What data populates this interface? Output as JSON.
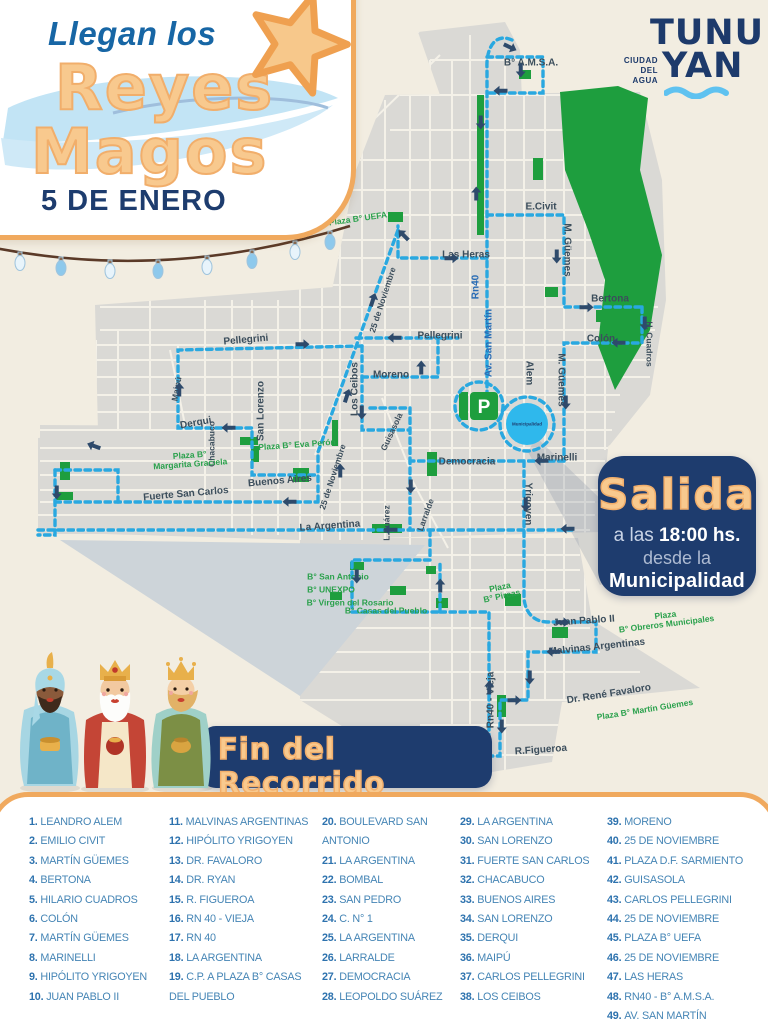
{
  "header": {
    "title_top": "Llegan los",
    "title_main_1": "Reyes",
    "title_main_2": "Magos",
    "date": "5 DE ENERO"
  },
  "logo": {
    "line1": "TUNU",
    "line2": "YAN",
    "tagline1": "CIUDAD",
    "tagline2": "DEL",
    "tagline3": "AGUA"
  },
  "salida": {
    "title": "Salida",
    "line1_pre": "a las ",
    "line1_bold": "18:00 hs.",
    "line2": "desde la",
    "line3": "Municipalidad"
  },
  "fin": {
    "title": "Fin del Recorrido",
    "sub_pre": "a las ",
    "sub_bold1": "22:00 hs.",
    "sub_mid": " aprox. en la ",
    "sub_bold2": "Plaza Departamental"
  },
  "map": {
    "roundabout_label": "Municipalidad",
    "parking_label": "P",
    "labels": [
      {
        "t": "B° A.M.S.A.",
        "x": 531,
        "y": 64,
        "r": 0,
        "c": "st"
      },
      {
        "t": "E.Civit",
        "x": 541,
        "y": 208,
        "r": 0,
        "c": "st"
      },
      {
        "t": "M. Güemes",
        "x": 566,
        "y": 250,
        "r": 90,
        "c": "st"
      },
      {
        "t": "Las Heras",
        "x": 466,
        "y": 256,
        "r": 0,
        "c": "st"
      },
      {
        "t": "Bertona",
        "x": 610,
        "y": 300,
        "r": 0,
        "c": "st"
      },
      {
        "t": "Colón",
        "x": 601,
        "y": 340,
        "r": 0,
        "c": "st"
      },
      {
        "t": "H. Cuadros",
        "x": 649,
        "y": 344,
        "r": 90,
        "c": "st sm"
      },
      {
        "t": "M. Güemes",
        "x": 560,
        "y": 380,
        "r": 90,
        "c": "st"
      },
      {
        "t": "Plaza B° UEFA",
        "x": 358,
        "y": 219,
        "r": -8,
        "c": "pz"
      },
      {
        "t": "Pellegrini",
        "x": 246,
        "y": 341,
        "r": -5,
        "c": "st"
      },
      {
        "t": "Pellegrini",
        "x": 440,
        "y": 337,
        "r": 0,
        "c": "st"
      },
      {
        "t": "Moreno",
        "x": 391,
        "y": 376,
        "r": 0,
        "c": "st"
      },
      {
        "t": "25 de Noviembre",
        "x": 383,
        "y": 300,
        "r": -72,
        "c": "st sm"
      },
      {
        "t": "Rn40",
        "x": 477,
        "y": 287,
        "r": -90,
        "c": "hw"
      },
      {
        "t": "Av. San Martín",
        "x": 490,
        "y": 343,
        "r": -90,
        "c": "hw"
      },
      {
        "t": "Alem",
        "x": 528,
        "y": 373,
        "r": 90,
        "c": "st"
      },
      {
        "t": "Maipú",
        "x": 177,
        "y": 389,
        "r": -80,
        "c": "st sm"
      },
      {
        "t": "Derqui",
        "x": 196,
        "y": 424,
        "r": -10,
        "c": "st"
      },
      {
        "t": "San Lorenzo",
        "x": 262,
        "y": 411,
        "r": -90,
        "c": "st"
      },
      {
        "t": "Los Ceibos",
        "x": 356,
        "y": 389,
        "r": -90,
        "c": "st"
      },
      {
        "t": "Chacabuco",
        "x": 212,
        "y": 444,
        "r": -90,
        "c": "st sm"
      },
      {
        "t": "Plaza B°\nMargarita Graciela",
        "x": 190,
        "y": 460,
        "r": -4,
        "c": "pz"
      },
      {
        "t": "Plaza B° Eva Perón",
        "x": 297,
        "y": 445,
        "r": -4,
        "c": "pz"
      },
      {
        "t": "Buenos Aires",
        "x": 280,
        "y": 482,
        "r": -5,
        "c": "st"
      },
      {
        "t": "Fuerte San Carlos",
        "x": 186,
        "y": 495,
        "r": -5,
        "c": "st"
      },
      {
        "t": "25 de Noviembre",
        "x": 333,
        "y": 477,
        "r": -72,
        "c": "st sm"
      },
      {
        "t": "Guisasola",
        "x": 392,
        "y": 432,
        "r": -65,
        "c": "st sm"
      },
      {
        "t": "La Argentina",
        "x": 330,
        "y": 527,
        "r": -4,
        "c": "st"
      },
      {
        "t": "L.Suárez",
        "x": 387,
        "y": 523,
        "r": -90,
        "c": "st sm"
      },
      {
        "t": "Larralde",
        "x": 426,
        "y": 515,
        "r": -70,
        "c": "st sm"
      },
      {
        "t": "Democracia",
        "x": 467,
        "y": 463,
        "r": 0,
        "c": "st"
      },
      {
        "t": "Marinelli",
        "x": 557,
        "y": 459,
        "r": 0,
        "c": "st"
      },
      {
        "t": "Yrigoyen",
        "x": 527,
        "y": 504,
        "r": 90,
        "c": "st"
      },
      {
        "t": "B° San Antonio",
        "x": 338,
        "y": 577,
        "r": 0,
        "c": "pz"
      },
      {
        "t": "B° UNEXPO",
        "x": 331,
        "y": 590,
        "r": 0,
        "c": "pz"
      },
      {
        "t": "B° Virgen del Rosario",
        "x": 350,
        "y": 603,
        "r": 0,
        "c": "pz"
      },
      {
        "t": "B° Casas del Pueblo",
        "x": 386,
        "y": 611,
        "r": 0,
        "c": "pz"
      },
      {
        "t": "Plaza\nB° Pircas",
        "x": 501,
        "y": 592,
        "r": -12,
        "c": "pz"
      },
      {
        "t": "Juan Pablo II",
        "x": 584,
        "y": 622,
        "r": -4,
        "c": "st"
      },
      {
        "t": "Plaza\nB° Obreros Municipales",
        "x": 666,
        "y": 620,
        "r": -7,
        "c": "pz"
      },
      {
        "t": "Malvinas Argentinas",
        "x": 597,
        "y": 648,
        "r": -6,
        "c": "st"
      },
      {
        "t": "Dr. René Favaloro",
        "x": 609,
        "y": 695,
        "r": -9,
        "c": "st"
      },
      {
        "t": "Plaza B° Martín Güemes",
        "x": 645,
        "y": 710,
        "r": -9,
        "c": "pz"
      },
      {
        "t": "Rn40 - Vieja",
        "x": 492,
        "y": 700,
        "r": -90,
        "c": "st"
      },
      {
        "t": "R.Figueroa",
        "x": 541,
        "y": 751,
        "r": -4,
        "c": "st"
      }
    ],
    "arrows": [
      [
        508,
        46,
        25
      ],
      [
        521,
        68,
        90
      ],
      [
        503,
        91,
        180
      ],
      [
        481,
        120,
        90
      ],
      [
        476,
        196,
        -90
      ],
      [
        449,
        258,
        0
      ],
      [
        405,
        237,
        -135
      ],
      [
        557,
        254,
        90
      ],
      [
        584,
        307,
        0
      ],
      [
        645,
        321,
        90
      ],
      [
        621,
        343,
        180
      ],
      [
        566,
        400,
        90
      ],
      [
        544,
        461,
        180
      ],
      [
        526,
        502,
        90
      ],
      [
        560,
        622,
        0
      ],
      [
        556,
        652,
        180
      ],
      [
        530,
        675,
        90
      ],
      [
        512,
        700,
        0
      ],
      [
        502,
        724,
        90
      ],
      [
        461,
        756,
        180
      ],
      [
        489,
        690,
        -90
      ],
      [
        300,
        344,
        0
      ],
      [
        397,
        338,
        180
      ],
      [
        179,
        392,
        -90
      ],
      [
        231,
        428,
        180
      ],
      [
        372,
        302,
        -72
      ],
      [
        346,
        398,
        -72
      ],
      [
        421,
        370,
        -90
      ],
      [
        362,
        410,
        90
      ],
      [
        411,
        484,
        90
      ],
      [
        393,
        530,
        180
      ],
      [
        570,
        529,
        180
      ],
      [
        292,
        502,
        180
      ],
      [
        340,
        473,
        -90
      ],
      [
        357,
        574,
        90
      ],
      [
        440,
        588,
        -90
      ],
      [
        96,
        447,
        -160
      ],
      [
        57,
        490,
        90
      ]
    ]
  },
  "streets": {
    "columns": [
      [
        {
          "n": "1.",
          "name": "LEANDRO ALEM"
        },
        {
          "n": "2.",
          "name": "EMILIO CIVIT"
        },
        {
          "n": "3.",
          "name": "MARTÍN GÜEMES"
        },
        {
          "n": "4.",
          "name": "BERTONA"
        },
        {
          "n": "5.",
          "name": "HILARIO CUADROS"
        },
        {
          "n": "6.",
          "name": "COLÓN"
        },
        {
          "n": "7.",
          "name": "MARTÍN GÜEMES"
        },
        {
          "n": "8.",
          "name": "MARINELLI"
        },
        {
          "n": "9.",
          "name": "HIPÓLITO YRIGOYEN"
        },
        {
          "n": "10.",
          "name": "JUAN PABLO II"
        }
      ],
      [
        {
          "n": "11.",
          "name": "MALVINAS ARGENTINAS"
        },
        {
          "n": "12.",
          "name": "HIPÓLITO YRIGOYEN"
        },
        {
          "n": "13.",
          "name": "DR. FAVALORO"
        },
        {
          "n": "14.",
          "name": "DR. RYAN"
        },
        {
          "n": "15.",
          "name": "R. FIGUEROA"
        },
        {
          "n": "16.",
          "name": "RN 40 - VIEJA"
        },
        {
          "n": "17.",
          "name": "RN 40"
        },
        {
          "n": "18.",
          "name": "LA ARGENTINA"
        },
        {
          "n": "19.",
          "name": "C.P. A PLAZA B° CASAS DEL PUEBLO"
        }
      ],
      [
        {
          "n": "20.",
          "name": "BOULEVARD SAN ANTONIO"
        },
        {
          "n": "21.",
          "name": "LA ARGENTINA"
        },
        {
          "n": "22.",
          "name": "BOMBAL"
        },
        {
          "n": "23.",
          "name": "SAN PEDRO"
        },
        {
          "n": "24.",
          "name": "C. N° 1"
        },
        {
          "n": "25.",
          "name": "LA ARGENTINA"
        },
        {
          "n": "26.",
          "name": "LARRALDE"
        },
        {
          "n": "27.",
          "name": "DEMOCRACIA"
        },
        {
          "n": "28.",
          "name": "LEOPOLDO SUÁREZ"
        }
      ],
      [
        {
          "n": "29.",
          "name": "LA ARGENTINA"
        },
        {
          "n": "30.",
          "name": "SAN LORENZO"
        },
        {
          "n": "31.",
          "name": "FUERTE SAN CARLOS"
        },
        {
          "n": "32.",
          "name": "CHACABUCO"
        },
        {
          "n": "33.",
          "name": "BUENOS AIRES"
        },
        {
          "n": "34.",
          "name": "SAN LORENZO"
        },
        {
          "n": "35.",
          "name": "DERQUI"
        },
        {
          "n": "36.",
          "name": "MAIPÚ"
        },
        {
          "n": "37.",
          "name": "CARLOS PELLEGRINI"
        },
        {
          "n": "38.",
          "name": "LOS CEIBOS"
        }
      ],
      [
        {
          "n": "39.",
          "name": "MORENO"
        },
        {
          "n": "40.",
          "name": "25 DE NOVIEMBRE"
        },
        {
          "n": "41.",
          "name": "PLAZA D.F. SARMIENTO"
        },
        {
          "n": "42.",
          "name": "GUISASOLA"
        },
        {
          "n": "43.",
          "name": "CARLOS PELLEGRINI"
        },
        {
          "n": "44.",
          "name": "25 DE NOVIEMBRE"
        },
        {
          "n": "45.",
          "name": "PLAZA B° UEFA"
        },
        {
          "n": "46.",
          "name": "25 DE NOVIEMBRE"
        },
        {
          "n": "47.",
          "name": "LAS HERAS"
        },
        {
          "n": "48.",
          "name": "RN40 - B° A.M.S.A."
        },
        {
          "n": "49.",
          "name": "AV. SAN MARTÍN"
        }
      ]
    ]
  },
  "colors": {
    "background": "#F2EDE1",
    "accent_orange": "#F0A95E",
    "title_orange": "#F8C98E",
    "navy": "#1E3C6E",
    "route_cyan": "#29A8E0",
    "park_green": "#1E9E3E",
    "plaza_text_green": "#2AA14C",
    "list_blue": "#2D72AE",
    "script_blue": "#1766A5"
  }
}
